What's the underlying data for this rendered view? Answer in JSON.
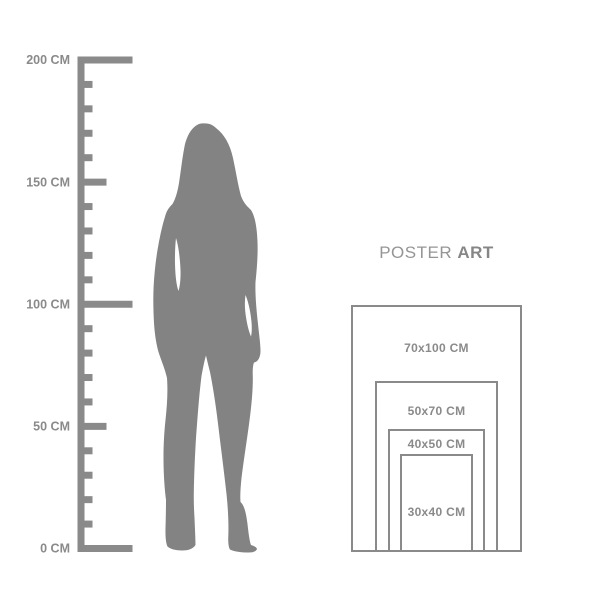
{
  "colors": {
    "line": "#8a8a8a",
    "silhouette": "#838383",
    "label_text": "#8a8a8a",
    "title_regular": "#959595",
    "title_bold": "#868686",
    "background": "#ffffff"
  },
  "title": {
    "regular": "POSTER",
    "bold": "ART"
  },
  "ruler": {
    "unit": "CM",
    "min_cm": 0,
    "max_cm": 200,
    "major_step_cm": 50,
    "minor_step_cm": 10,
    "major_labels": [
      "0 CM",
      "50 CM",
      "100 CM",
      "150 CM",
      "200 CM"
    ]
  },
  "figure": {
    "description": "standing woman silhouette"
  },
  "poster_sizes": [
    {
      "label": "70x100 CM",
      "width_cm": 70,
      "height_cm": 100
    },
    {
      "label": "50x70 CM",
      "width_cm": 50,
      "height_cm": 70
    },
    {
      "label": "40x50 CM",
      "width_cm": 40,
      "height_cm": 50
    },
    {
      "label": "30x40 CM",
      "width_cm": 30,
      "height_cm": 40
    }
  ]
}
